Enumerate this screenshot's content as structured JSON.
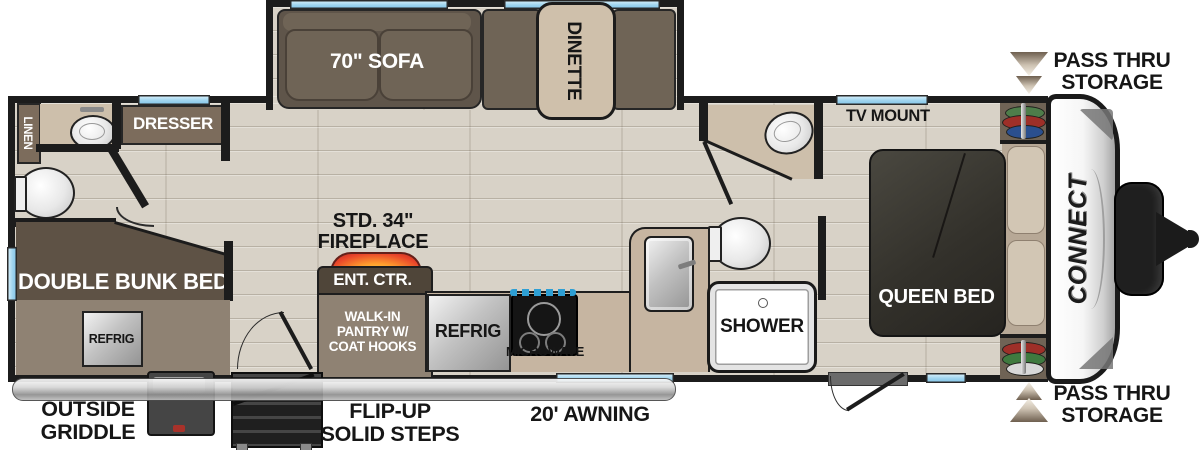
{
  "title": "Travel trailer floor plan",
  "brand": {
    "logo": "CONNECT"
  },
  "colors": {
    "wall": "#1c1c1c",
    "floor": "#d8d2c7",
    "cabinet": "#7c6c5c",
    "bunk_dark": "#5e5245",
    "taupe": "#8f8273",
    "counter_tan": "#c6b5a1",
    "sofa": "#6f6456",
    "window_blue": "#9fd4ee",
    "fireplace_accent": "#e8432a"
  },
  "slideout": {
    "sofa": "70\" SOFA",
    "dinette": "DINETTE"
  },
  "rear": {
    "linen": "LINEN",
    "dresser": "DRESSER",
    "bunk": "DOUBLE BUNK BED",
    "refrig": "REFRIG"
  },
  "center": {
    "fireplace_l1": "STD. 34\"",
    "fireplace_l2": "FIREPLACE",
    "ent_ctr": "ENT. CTR.",
    "pantry_l1": "WALK-IN",
    "pantry_l2": "PANTRY W/",
    "pantry_l3": "COAT HOOKS"
  },
  "kitchen": {
    "refrig": "REFRIG",
    "microwave": "MICROWAVE"
  },
  "bath": {
    "shower": "SHOWER"
  },
  "bedroom": {
    "tv_mount": "TV MOUNT",
    "bed": "QUEEN BED"
  },
  "exterior": {
    "griddle_l1": "OUTSIDE",
    "griddle_l2": "GRIDDLE",
    "steps_l1": "FLIP-UP",
    "steps_l2": "SOLID STEPS",
    "awning": "20' AWNING",
    "pass_thru_top_l1": "PASS THRU",
    "pass_thru_top_l2": "STORAGE",
    "pass_thru_bottom_l1": "PASS THRU",
    "pass_thru_bottom_l2": "STORAGE"
  }
}
